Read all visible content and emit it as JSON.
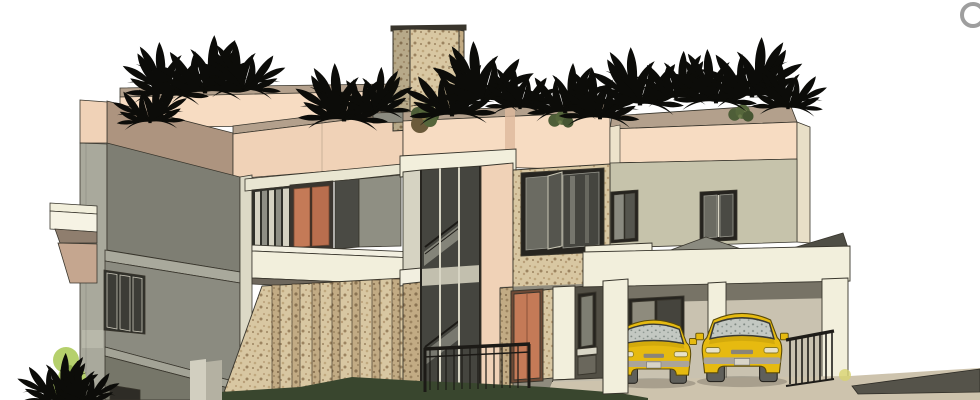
{
  "meta": {
    "title": "3D architectural exterior render",
    "description": "Front-left perspective render of a two-storey modern villa: gray left wing, stone feature tower, glazed staircase, stone-framed entry, beige right wing and double carport with two yellow SUVs; black silhouette plants line the rooftop parapets.",
    "width": 980,
    "height": 400
  },
  "ui": {
    "orbit_ring_icon": "partial gray navigation ring, top-right corner"
  },
  "scene": {
    "left_wing": "two-storey gray block with slatted windows and white ledge",
    "roof_garden": "black tropical plant silhouettes on parapets",
    "tower": "stone-clad tower rising above roof",
    "balcony": "balcony with terracotta double door and louver screen",
    "stair_glazing": "full-height glazed stair with visible flights",
    "entry": "stone entry bay with terracotta door and white columns",
    "right_wing": "beige wing, two dark windows, small hip porch roof",
    "carport": "cream fascia carport with columns and railing",
    "vehicle_count": 2,
    "vehicles": [
      "yellow SUV",
      "yellow SUV"
    ],
    "landscape": [
      "light green shrub",
      "black ground plants",
      "dark hedge shadow",
      "stone louver wall",
      "dark driveway ramp"
    ]
  },
  "colors": {
    "background": "#ffffff",
    "peach_light": "#f7dcc2",
    "peach": "#f0d2b7",
    "tan_top": "#b3a08c",
    "tan_band": "#ad947f",
    "gray_wall_dark": "#7e7e73",
    "gray_wall": "#8b8b80",
    "gray_wall_light": "#a9a99c",
    "green_gray_wall": "#c6c3ab",
    "cream": "#f2efdc",
    "cream_dim": "#dcd9c6",
    "stone_light": "#d8c7a2",
    "stone_dark": "#b89e78",
    "stone_darker": "#9c8460",
    "glass_dark": "#45453f",
    "glass_mid": "#6b6b62",
    "glass_light": "#8f8f84",
    "frame_dark": "#26241f",
    "door_terracotta": "#c47a57",
    "car_yellow": "#e6ba10",
    "car_glass": "#c3c8c2",
    "car_gray": "#aaa49a",
    "wheel": "#5f5f5a",
    "plant_black": "#0c0c09",
    "bush_green": "#b5d06c",
    "bush_dark": "#4e5e38",
    "shadow_green": "#39462e",
    "ground_tan": "#cdc3ad",
    "ground_dark": "#55534a",
    "soffit": "#6e6a5e",
    "pyramid_gray": "#8b8b80",
    "ring_icon": "#9e9e9e"
  }
}
